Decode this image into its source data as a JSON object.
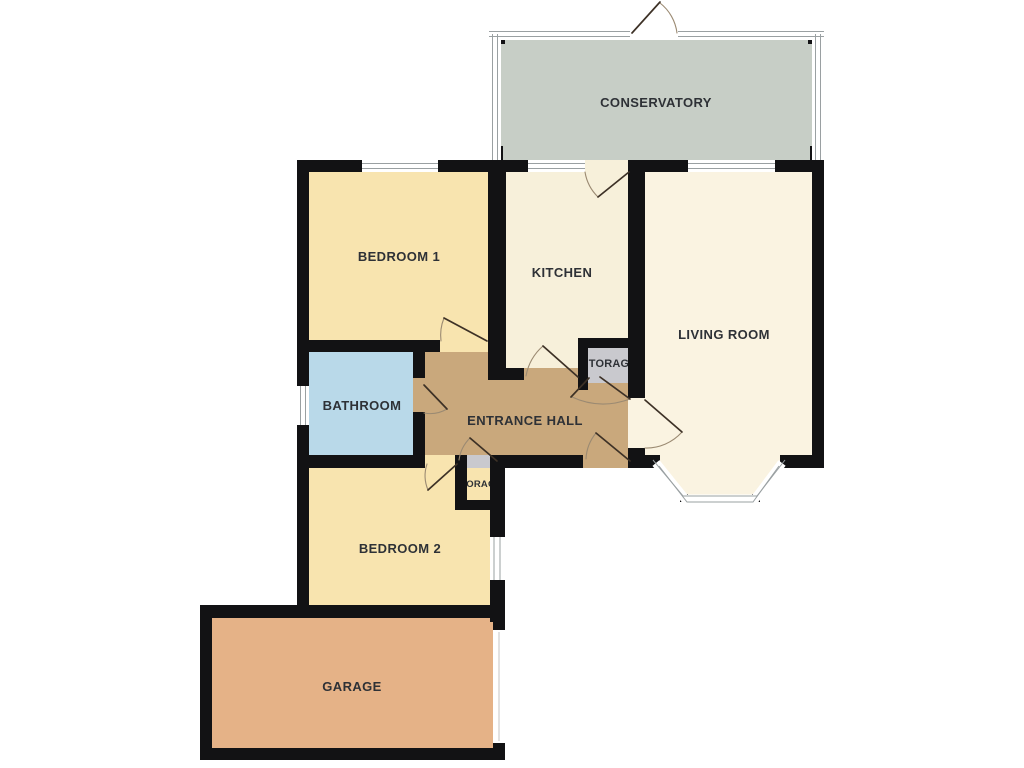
{
  "plan": {
    "type": "floorplan",
    "description_visible_rooms": 10
  },
  "palette": {
    "background": "#ffffff",
    "wall": "#121214",
    "window_fill": "#ffffff",
    "window_frame_line": "#9aa0a2",
    "door_line": "#3d3126",
    "door_arc": "#9b8a72",
    "label": "#2e3136",
    "opening_line": "#c4c4c4"
  },
  "rooms": {
    "conservatory": {
      "label": "CONSERVATORY",
      "color": "#c7cec6"
    },
    "bedroom1": {
      "label": "BEDROOM 1",
      "color": "#f8e4af"
    },
    "kitchen": {
      "label": "KITCHEN",
      "color": "#f7f0da"
    },
    "living_room": {
      "label": "LIVING ROOM",
      "color": "#faf3e1"
    },
    "bathroom": {
      "label": "BATHROOM",
      "color": "#b9d9e9"
    },
    "entrance_hall": {
      "label": "ENTRANCE HALL",
      "color": "#c9a87c"
    },
    "storage_upper": {
      "label": "TORAG",
      "color": "#c9c9ce"
    },
    "storage_lower": {
      "label": "TORAG",
      "color": "#c9c9ce"
    },
    "bedroom2": {
      "label": "BEDROOM 2",
      "color": "#f8e4af"
    },
    "garage": {
      "label": "GARAGE",
      "color": "#e5b287"
    }
  }
}
